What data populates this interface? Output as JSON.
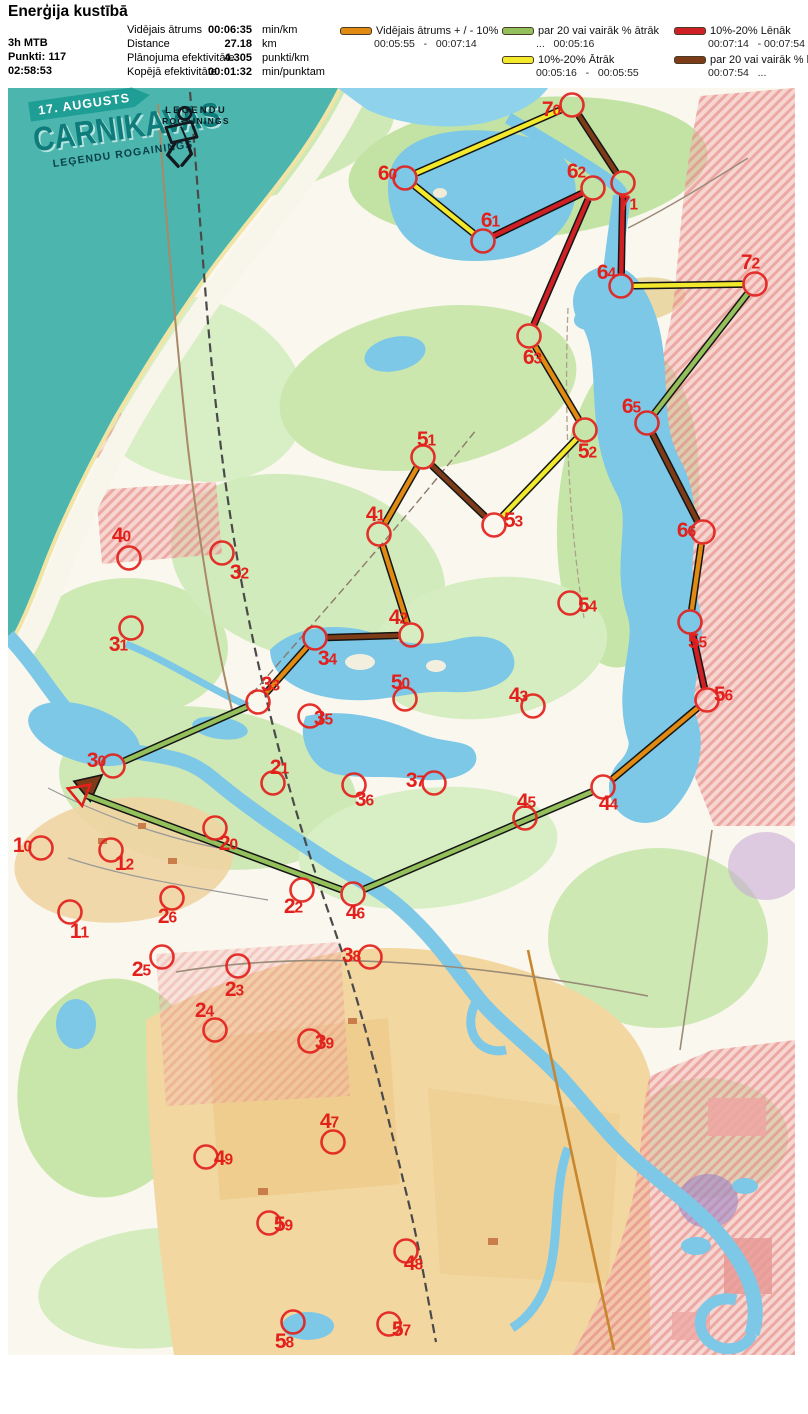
{
  "header": {
    "title": "Enerģija kustībā",
    "left": [
      "3h MTB",
      "Punkti: 117",
      "02:58:53"
    ],
    "stats": [
      {
        "label": "Vidējais ātrums",
        "value": "00:06:35",
        "unit": "min/km"
      },
      {
        "label": "Distance",
        "value": "27.18",
        "unit": "km"
      },
      {
        "label": "Plānojuma efektivitāte",
        "value": "4.305",
        "unit": "punkti/km"
      },
      {
        "label": "Kopējā efektivitāte",
        "value": "00:01:32",
        "unit": "min/punktam"
      }
    ],
    "colors": {
      "avg": "#e08a12",
      "fast20": "#94c05c",
      "fast10": "#f2e92c",
      "slow10": "#cf2025",
      "slow20": "#7d3c17"
    },
    "legend": {
      "col1": [
        {
          "speed": "avg",
          "label": "Vidējais ātrums + / - 10%",
          "range": "00:05:55   -   00:07:14"
        }
      ],
      "col2": [
        {
          "speed": "fast20",
          "label": "par 20 vai vairāk % ātrāk",
          "range": "...   00:05:16"
        },
        {
          "speed": "fast10",
          "label": "10%-20% Ātrāk",
          "range": "00:05:16   -   00:05:55"
        }
      ],
      "col3": [
        {
          "speed": "slow10",
          "label": "10%-20% Lēnāk",
          "range": "00:07:14   - 00:07:54"
        },
        {
          "speed": "slow20",
          "label": "par 20 vai vairāk % lēnāk",
          "range": "00:07:54   ..."
        }
      ]
    }
  },
  "banner": {
    "date": "17. AUGUSTS",
    "title": "CARNIKAVAS",
    "subtitle": "LEĢENDU ROGAININGS",
    "logo_line1": "LEĢENDU",
    "logo_line2": "ROGAININGS"
  },
  "map": {
    "marker_color": "#e2211c",
    "start": {
      "x": 72,
      "y": 705
    },
    "controls": [
      {
        "id": "70",
        "cx": 564,
        "cy": 17,
        "lx": 543,
        "ly": 21
      },
      {
        "id": "60",
        "cx": 397,
        "cy": 90,
        "lx": 379,
        "ly": 85
      },
      {
        "id": "61",
        "cx": 475,
        "cy": 153,
        "lx": 482,
        "ly": 132
      },
      {
        "id": "62",
        "cx": 585,
        "cy": 100,
        "lx": 568,
        "ly": 83
      },
      {
        "id": "71",
        "cx": 615,
        "cy": 95,
        "lx": 620,
        "ly": 115
      },
      {
        "id": "64",
        "cx": 613,
        "cy": 198,
        "lx": 598,
        "ly": 184
      },
      {
        "id": "72",
        "cx": 747,
        "cy": 196,
        "lx": 742,
        "ly": 174
      },
      {
        "id": "63",
        "cx": 521,
        "cy": 248,
        "lx": 524,
        "ly": 269
      },
      {
        "id": "52",
        "cx": 577,
        "cy": 342,
        "lx": 579,
        "ly": 363
      },
      {
        "id": "65",
        "cx": 639,
        "cy": 335,
        "lx": 623,
        "ly": 318
      },
      {
        "id": "51",
        "cx": 415,
        "cy": 369,
        "lx": 418,
        "ly": 351
      },
      {
        "id": "53",
        "cx": 486,
        "cy": 437,
        "lx": 505,
        "ly": 432
      },
      {
        "id": "66",
        "cx": 695,
        "cy": 444,
        "lx": 678,
        "ly": 442
      },
      {
        "id": "54",
        "cx": 562,
        "cy": 515,
        "lx": 579,
        "ly": 517
      },
      {
        "id": "55",
        "cx": 682,
        "cy": 534,
        "lx": 689,
        "ly": 553
      },
      {
        "id": "56",
        "cx": 699,
        "cy": 612,
        "lx": 715,
        "ly": 606
      },
      {
        "id": "40",
        "cx": 121,
        "cy": 470,
        "lx": 113,
        "ly": 447
      },
      {
        "id": "32",
        "cx": 214,
        "cy": 465,
        "lx": 231,
        "ly": 484
      },
      {
        "id": "31",
        "cx": 123,
        "cy": 540,
        "lx": 110,
        "ly": 556
      },
      {
        "id": "41",
        "cx": 371,
        "cy": 446,
        "lx": 367,
        "ly": 426
      },
      {
        "id": "42",
        "cx": 403,
        "cy": 547,
        "lx": 390,
        "ly": 529
      },
      {
        "id": "34",
        "cx": 307,
        "cy": 550,
        "lx": 319,
        "ly": 570
      },
      {
        "id": "33",
        "cx": 250,
        "cy": 614,
        "lx": 262,
        "ly": 596
      },
      {
        "id": "35",
        "cx": 302,
        "cy": 628,
        "lx": 315,
        "ly": 630
      },
      {
        "id": "50",
        "cx": 397,
        "cy": 611,
        "lx": 392,
        "ly": 594
      },
      {
        "id": "43",
        "cx": 525,
        "cy": 618,
        "lx": 510,
        "ly": 607
      },
      {
        "id": "37",
        "cx": 426,
        "cy": 695,
        "lx": 407,
        "ly": 692
      },
      {
        "id": "36",
        "cx": 346,
        "cy": 697,
        "lx": 356,
        "ly": 711
      },
      {
        "id": "21",
        "cx": 265,
        "cy": 695,
        "lx": 271,
        "ly": 679
      },
      {
        "id": "45",
        "cx": 517,
        "cy": 730,
        "lx": 518,
        "ly": 713
      },
      {
        "id": "44",
        "cx": 595,
        "cy": 699,
        "lx": 600,
        "ly": 715
      },
      {
        "id": "20",
        "cx": 207,
        "cy": 740,
        "lx": 220,
        "ly": 755
      },
      {
        "id": "30",
        "cx": 105,
        "cy": 678,
        "lx": 88,
        "ly": 672
      },
      {
        "id": "22",
        "cx": 294,
        "cy": 802,
        "lx": 285,
        "ly": 818
      },
      {
        "id": "46",
        "cx": 345,
        "cy": 806,
        "lx": 347,
        "ly": 824
      },
      {
        "id": "10",
        "cx": 33,
        "cy": 760,
        "lx": 14,
        "ly": 757
      },
      {
        "id": "12",
        "cx": 103,
        "cy": 762,
        "lx": 116,
        "ly": 775
      },
      {
        "id": "26",
        "cx": 164,
        "cy": 810,
        "lx": 159,
        "ly": 828
      },
      {
        "id": "11",
        "cx": 62,
        "cy": 824,
        "lx": 71,
        "ly": 843
      },
      {
        "id": "25",
        "cx": 154,
        "cy": 869,
        "lx": 133,
        "ly": 881
      },
      {
        "id": "38",
        "cx": 362,
        "cy": 869,
        "lx": 343,
        "ly": 867
      },
      {
        "id": "23",
        "cx": 230,
        "cy": 878,
        "lx": 226,
        "ly": 901
      },
      {
        "id": "24",
        "cx": 207,
        "cy": 942,
        "lx": 196,
        "ly": 922
      },
      {
        "id": "39",
        "cx": 302,
        "cy": 953,
        "lx": 316,
        "ly": 954
      },
      {
        "id": "49",
        "cx": 198,
        "cy": 1069,
        "lx": 215,
        "ly": 1070
      },
      {
        "id": "47",
        "cx": 325,
        "cy": 1054,
        "lx": 321,
        "ly": 1033
      },
      {
        "id": "59",
        "cx": 261,
        "cy": 1135,
        "lx": 275,
        "ly": 1136
      },
      {
        "id": "48",
        "cx": 398,
        "cy": 1163,
        "lx": 405,
        "ly": 1175
      },
      {
        "id": "58",
        "cx": 285,
        "cy": 1234,
        "lx": 276,
        "ly": 1253
      },
      {
        "id": "57",
        "cx": 381,
        "cy": 1236,
        "lx": 393,
        "ly": 1241
      }
    ],
    "legs": [
      {
        "from": "start",
        "to": "30",
        "speed": "slow20",
        "arrow": true
      },
      {
        "from": "30",
        "to": "33",
        "speed": "fast20"
      },
      {
        "from": "33",
        "to": "34",
        "speed": "avg"
      },
      {
        "from": "34",
        "to": "42",
        "speed": "slow20"
      },
      {
        "from": "42",
        "to": "41",
        "speed": "avg"
      },
      {
        "from": "41",
        "to": "51",
        "speed": "avg"
      },
      {
        "from": "51",
        "to": "53",
        "speed": "slow20"
      },
      {
        "from": "53",
        "to": "52",
        "speed": "fast10"
      },
      {
        "from": "52",
        "to": "63",
        "speed": "avg"
      },
      {
        "from": "63",
        "to": "62",
        "speed": "slow10"
      },
      {
        "from": "62",
        "to": "61",
        "speed": "slow10"
      },
      {
        "from": "61",
        "to": "60",
        "speed": "fast10"
      },
      {
        "from": "60",
        "to": "70",
        "speed": "fast10"
      },
      {
        "from": "70",
        "to": "71",
        "speed": "slow20"
      },
      {
        "from": "71",
        "to": "64",
        "speed": "slow10"
      },
      {
        "from": "64",
        "to": "72",
        "speed": "fast10"
      },
      {
        "from": "72",
        "to": "65",
        "speed": "fast20"
      },
      {
        "from": "65",
        "to": "66",
        "speed": "slow20"
      },
      {
        "from": "66",
        "to": "55",
        "speed": "avg"
      },
      {
        "from": "55",
        "to": "56",
        "speed": "slow10"
      },
      {
        "from": "56",
        "to": "44",
        "speed": "avg"
      },
      {
        "from": "44",
        "to": "46",
        "speed": "fast20"
      },
      {
        "from": "46",
        "to": "start",
        "speed": "fast20"
      }
    ]
  }
}
